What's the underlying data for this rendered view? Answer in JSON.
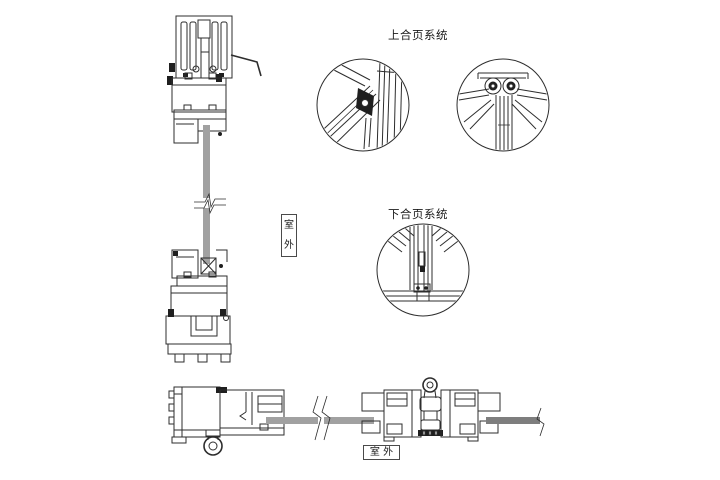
{
  "labels": {
    "upper_hinge_system": "上合页系统",
    "lower_hinge_system": "下合页系统",
    "outdoor_vertical": "室外",
    "outdoor_horizontal": "室 外"
  },
  "colors": {
    "line": "#2d2d2d",
    "ink": "#1f1f1f",
    "glass_light": "#a1a1a1",
    "glass_dark": "#7e7e7e",
    "background": "#ffffff",
    "label_border": "#4a4a4a",
    "text": "#1a1a1a"
  }
}
